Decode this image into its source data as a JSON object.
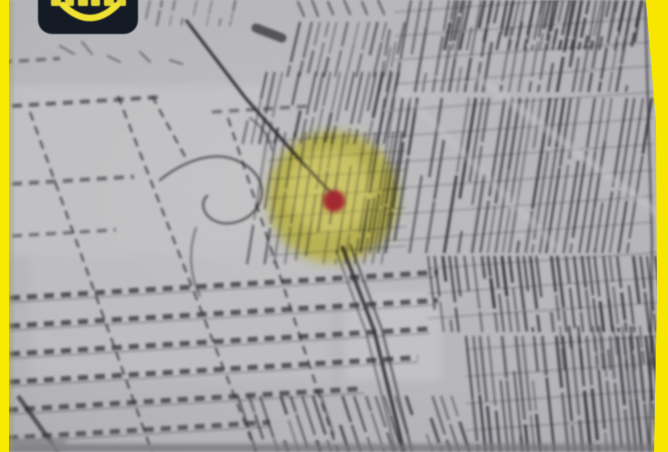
{
  "frame": {
    "left_strip_color": "#f8ea00",
    "right_strip_color": "#f6e600"
  },
  "logo_badge": {
    "icon": "smile-logo",
    "background": "#141b27",
    "accent": "#f0e233",
    "text_visible": false,
    "letter_fragments": 6
  },
  "map_photo": {
    "background": "#b8b8bc",
    "ink_color": "#2a2a2f",
    "light_street_color": "#c8c8cc",
    "highlight_circle": {
      "fill": "#f0e312",
      "center_x": 333,
      "center_y": 197,
      "radius": 66
    },
    "location_marker": {
      "color": "#a1242e",
      "x": 334,
      "y": 201,
      "radius": 11
    }
  }
}
